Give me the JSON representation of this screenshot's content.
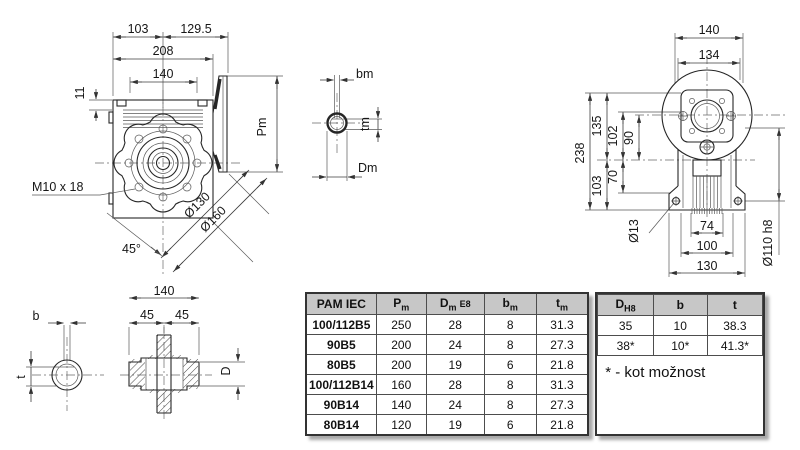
{
  "front_view": {
    "dim_width_left": "103",
    "dim_width_right": "129.5",
    "dim_total_width": "208",
    "dim_bolt_spacing": "140",
    "dim_offset": "11",
    "dim_motor_depth": "Pm",
    "thread_callout": "M10 x 18",
    "dim_bolt_circle": "Ø130",
    "dim_flange_od": "Ø160",
    "dim_angle": "45°"
  },
  "motor_shaft_view": {
    "dim_key_width": "bm",
    "dim_key_depth": "tm",
    "dim_bore": "Dm"
  },
  "side_view": {
    "dim_foot_width": "140",
    "dim_body_width": "134",
    "dim_total_height": "238",
    "dim_top_height": "135",
    "dim_flange_height": "102",
    "dim_axis_gap": "90",
    "dim_axis_height": "103",
    "dim_boss_drop": "70",
    "dim_foot_hole": "Ø13",
    "dim_fin_width": "74",
    "dim_hole_spacing": "100",
    "dim_foot_length": "130",
    "dim_spigot": "Ø110 h8"
  },
  "output_shaft_view": {
    "dim_key_width": "b",
    "dim_key_depth": "t",
    "dim_hub_length": "140",
    "dim_half_left": "45",
    "dim_half_right": "45",
    "dim_bore": "D"
  },
  "table": {
    "headers": [
      {
        "base": "PAM IEC",
        "sub": "",
        "suffix": ""
      },
      {
        "base": "P",
        "sub": "m",
        "suffix": ""
      },
      {
        "base": "D",
        "sub": "m",
        "suffix": "E8"
      },
      {
        "base": "b",
        "sub": "m",
        "suffix": ""
      },
      {
        "base": "t",
        "sub": "m",
        "suffix": ""
      }
    ],
    "rows": [
      [
        "100/112B5",
        "250",
        "28",
        "8",
        "31.3"
      ],
      [
        "90B5",
        "200",
        "24",
        "8",
        "27.3"
      ],
      [
        "80B5",
        "200",
        "19",
        "6",
        "21.8"
      ],
      [
        "100/112B14",
        "160",
        "28",
        "8",
        "31.3"
      ],
      [
        "90B14",
        "140",
        "24",
        "8",
        "27.3"
      ],
      [
        "80B14",
        "120",
        "19",
        "6",
        "21.8"
      ]
    ],
    "right_headers": [
      {
        "base": "D",
        "sub": "H8",
        "suffix": ""
      },
      {
        "base": "b",
        "sub": "",
        "suffix": ""
      },
      {
        "base": "t",
        "sub": "",
        "suffix": ""
      }
    ],
    "right_rows": [
      [
        "35",
        "10",
        "38.3"
      ],
      [
        "38*",
        "10*",
        "41.3*"
      ]
    ],
    "note": "* - kot možnost"
  }
}
